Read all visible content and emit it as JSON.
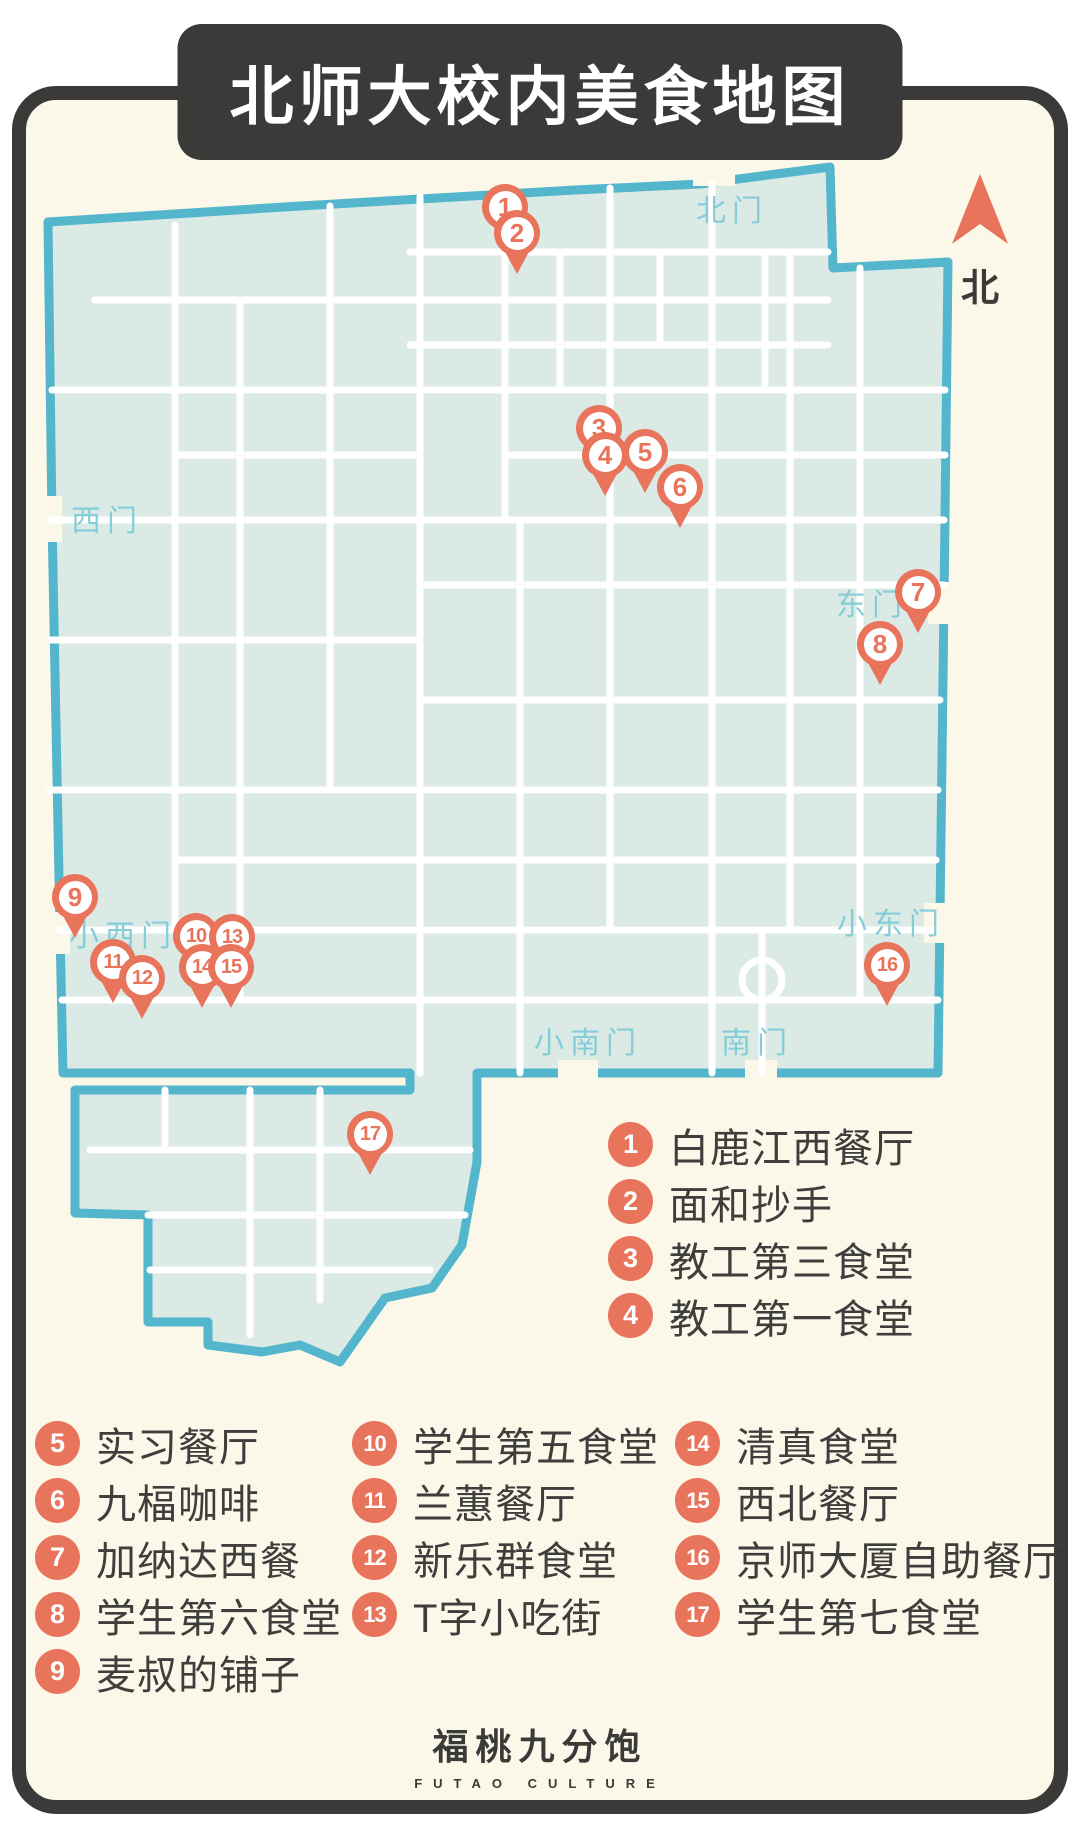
{
  "title": "北师大校内美食地图",
  "colors": {
    "accent": "#e8745c",
    "frame": "#3a3a38",
    "paper": "#fbf7e9",
    "map_fill": "#dceae5",
    "map_border": "#54b6cd",
    "road": "#ffffff",
    "gate_text": "#85cdd9"
  },
  "compass": {
    "label": "北"
  },
  "map": {
    "gates": [
      {
        "id": "north-gate",
        "label": "北门",
        "x": 732,
        "y": 208
      },
      {
        "id": "west-gate",
        "label": "西门",
        "x": 107,
        "y": 518
      },
      {
        "id": "east-gate",
        "label": "东门",
        "x": 872,
        "y": 602
      },
      {
        "id": "small-west-gate",
        "label": "小西门",
        "x": 123,
        "y": 933
      },
      {
        "id": "small-east-gate",
        "label": "小东门",
        "x": 891,
        "y": 921
      },
      {
        "id": "small-south-gate",
        "label": "小南门",
        "x": 588,
        "y": 1040
      },
      {
        "id": "south-gate",
        "label": "南门",
        "x": 757,
        "y": 1040
      }
    ],
    "pins": [
      {
        "n": 1,
        "x": 505,
        "y": 207
      },
      {
        "n": 2,
        "x": 517,
        "y": 233
      },
      {
        "n": 3,
        "x": 599,
        "y": 428
      },
      {
        "n": 4,
        "x": 605,
        "y": 455
      },
      {
        "n": 5,
        "x": 645,
        "y": 452
      },
      {
        "n": 6,
        "x": 680,
        "y": 487
      },
      {
        "n": 7,
        "x": 918,
        "y": 592
      },
      {
        "n": 8,
        "x": 880,
        "y": 644
      },
      {
        "n": 9,
        "x": 75,
        "y": 897
      },
      {
        "n": 10,
        "x": 196,
        "y": 936
      },
      {
        "n": 11,
        "x": 113,
        "y": 962
      },
      {
        "n": 12,
        "x": 142,
        "y": 978
      },
      {
        "n": 13,
        "x": 232,
        "y": 937
      },
      {
        "n": 14,
        "x": 202,
        "y": 967
      },
      {
        "n": 15,
        "x": 231,
        "y": 967
      },
      {
        "n": 16,
        "x": 887,
        "y": 965
      },
      {
        "n": 17,
        "x": 370,
        "y": 1134
      }
    ]
  },
  "legend": {
    "primary": [
      {
        "n": 1,
        "label": "白鹿江西餐厅"
      },
      {
        "n": 2,
        "label": "面和抄手"
      },
      {
        "n": 3,
        "label": "教工第三食堂"
      },
      {
        "n": 4,
        "label": "教工第一食堂"
      }
    ],
    "columns": [
      [
        {
          "n": 5,
          "label": "实习餐厅"
        },
        {
          "n": 6,
          "label": "九楅咖啡"
        },
        {
          "n": 7,
          "label": "加纳达西餐"
        },
        {
          "n": 8,
          "label": "学生第六食堂"
        },
        {
          "n": 9,
          "label": "麦叔的铺子"
        }
      ],
      [
        {
          "n": 10,
          "label": "学生第五食堂"
        },
        {
          "n": 11,
          "label": "兰蕙餐厅"
        },
        {
          "n": 12,
          "label": "新乐群食堂"
        },
        {
          "n": 13,
          "label": "T字小吃街"
        }
      ],
      [
        {
          "n": 14,
          "label": "清真食堂"
        },
        {
          "n": 15,
          "label": "西北餐厅"
        },
        {
          "n": 16,
          "label": "京师大厦自助餐厅"
        },
        {
          "n": 17,
          "label": "学生第七食堂"
        }
      ]
    ]
  },
  "footer": {
    "logo": "福桃九分饱",
    "sub": "FUTAO CULTURE"
  }
}
